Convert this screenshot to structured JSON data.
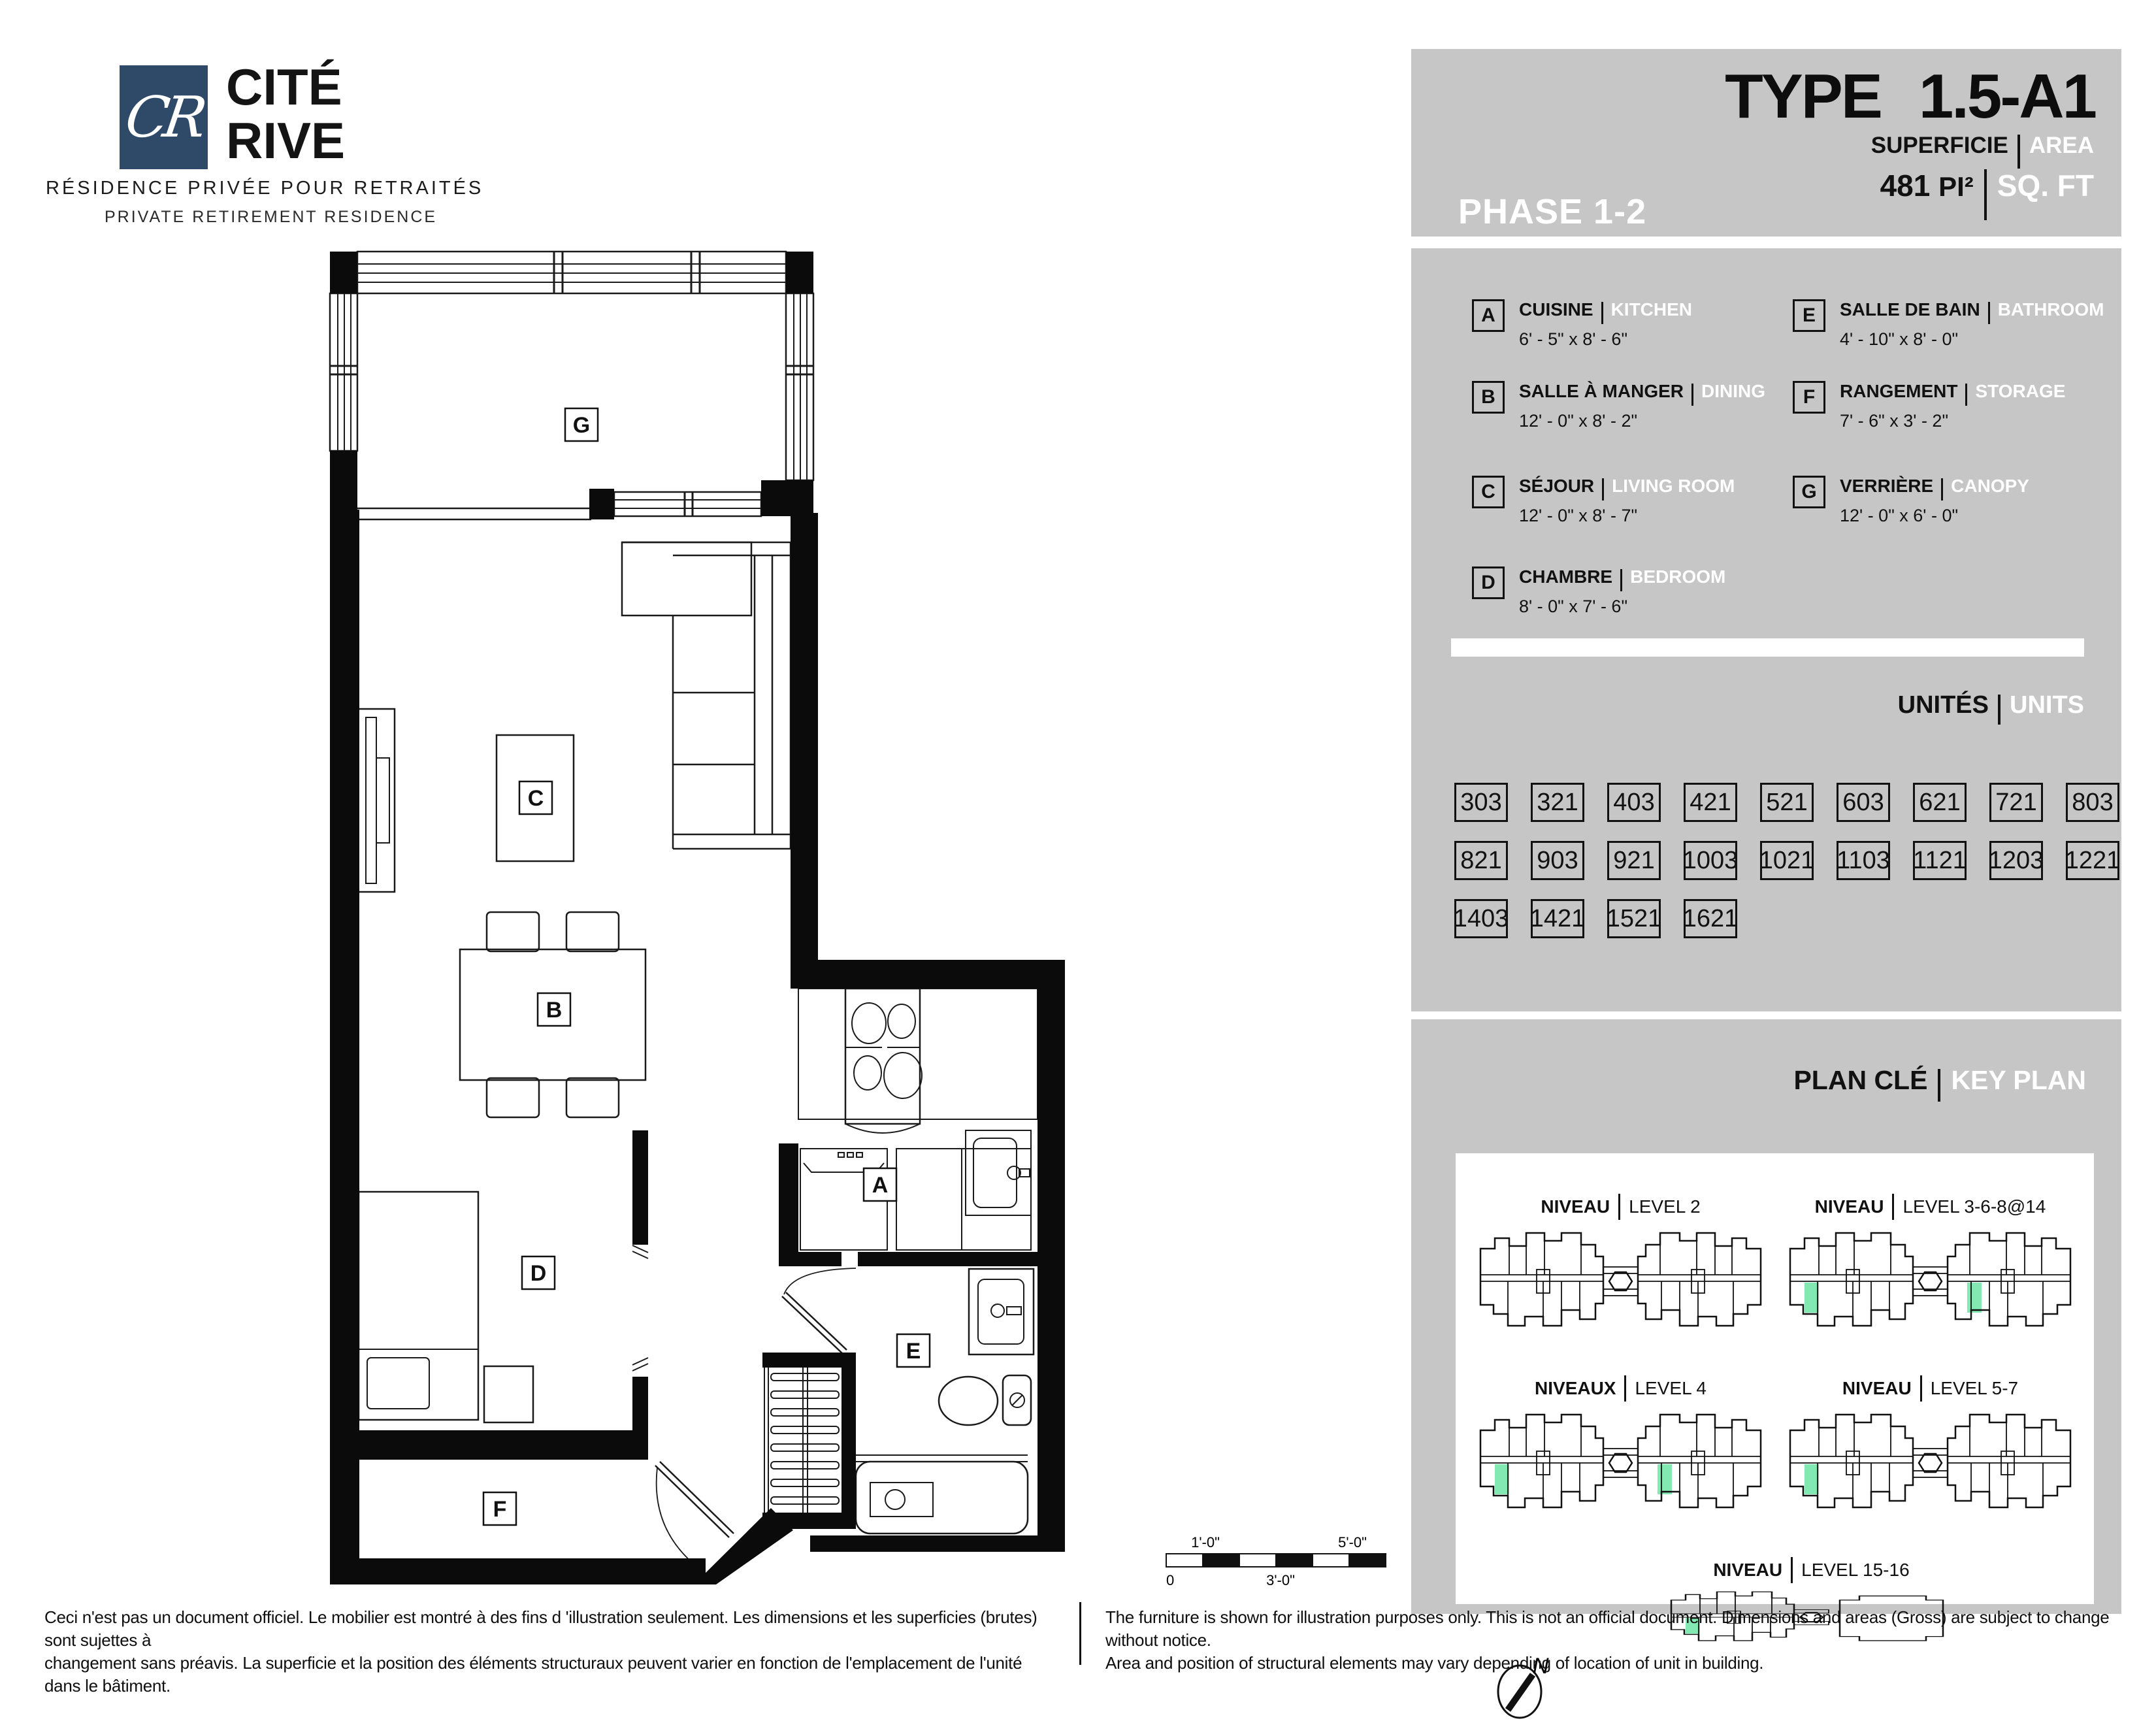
{
  "colors": {
    "navy": "#2f4a68",
    "panel_gray": "#c6c6c6",
    "highlight_green": "#82e9b2",
    "ink": "#111111"
  },
  "logo": {
    "monogram": "CR",
    "name_line1": "CITÉ",
    "name_line2": "RIVE",
    "tagline_fr": "RÉSIDENCE PRIVÉE POUR RETRAITÉS",
    "tagline_en": "PRIVATE RETIREMENT RESIDENCE"
  },
  "header": {
    "phase": "PHASE 1-2",
    "type_label": "TYPE",
    "type_value": "1.5-A1",
    "superficie_fr": "SUPERFICIE",
    "superficie_en": "AREA",
    "area_value": "481",
    "area_unit_fr": "PI²",
    "area_unit_en": "SQ. FT"
  },
  "legend": {
    "items": [
      {
        "letter": "A",
        "name_fr": "CUISINE",
        "name_en": "KITCHEN",
        "dims": "6' - 5\" x 8' - 6\""
      },
      {
        "letter": "B",
        "name_fr": "SALLE À MANGER",
        "name_en": "DINING",
        "dims": "12' - 0\" x 8' - 2\""
      },
      {
        "letter": "C",
        "name_fr": "SÉJOUR",
        "name_en": "LIVING ROOM",
        "dims": "12' - 0\" x 8' - 7\""
      },
      {
        "letter": "D",
        "name_fr": "CHAMBRE",
        "name_en": "BEDROOM",
        "dims": "8' - 0\" x 7' - 6\""
      },
      {
        "letter": "E",
        "name_fr": "SALLE DE BAIN",
        "name_en": "BATHROOM",
        "dims": "4' - 10\" x 8' - 0\""
      },
      {
        "letter": "F",
        "name_fr": "RANGEMENT",
        "name_en": "STORAGE",
        "dims": "7' - 6\" x 3' - 2\""
      },
      {
        "letter": "G",
        "name_fr": "VERRIÈRE",
        "name_en": "CANOPY",
        "dims": "12' - 0\" x 6' - 0\""
      }
    ]
  },
  "units": {
    "title_fr": "UNITÉS",
    "title_en": "UNITS",
    "numbers": [
      "303",
      "321",
      "403",
      "421",
      "521",
      "603",
      "621",
      "721",
      "803",
      "821",
      "903",
      "921",
      "1003",
      "1021",
      "1103",
      "1121",
      "1203",
      "1221",
      "1403",
      "1421",
      "1521",
      "1621"
    ]
  },
  "keyplan": {
    "title_fr": "PLAN CLÉ",
    "title_en": "KEY PLAN",
    "compass_letter": "N",
    "levels": [
      {
        "label_fr": "NIVEAU",
        "label_en": "LEVEL 2",
        "highlights": "none",
        "variant": "twin"
      },
      {
        "label_fr": "NIVEAU",
        "label_en": "LEVEL 3-6-8@14",
        "highlights": "both",
        "variant": "twin"
      },
      {
        "label_fr": "NIVEAUX",
        "label_en": "LEVEL 4",
        "highlights": "both",
        "variant": "twin"
      },
      {
        "label_fr": "NIVEAU",
        "label_en": "LEVEL 5-7",
        "highlights": "left",
        "variant": "twin"
      },
      {
        "label_fr": "NIVEAU",
        "label_en": "LEVEL 15-16",
        "highlights": "left",
        "variant": "tower"
      }
    ]
  },
  "plan": {
    "room_markers": [
      "G",
      "C",
      "B",
      "A",
      "D",
      "E",
      "F"
    ]
  },
  "scalebar": {
    "zero": "0",
    "one": "1'-0\"",
    "three": "3'-0\"",
    "five": "5'-0\""
  },
  "footer": {
    "fr_line1": "Ceci n'est pas un document officiel.  Le mobilier est montré à des fins d 'illustration seulement.  Les dimensions et les superficies (brutes) sont sujettes à",
    "fr_line2": "changement sans préavis. La superficie et la position des éléments structuraux peuvent varier en fonction de l'emplacement de l'unité dans le bâtiment.",
    "en_line1": "The furniture is shown for illustration purposes only.  This is not an official document.  Dimensions and areas (Gross) are subject to change without notice.",
    "en_line2": "Area and position of structural elements may vary depending of location of unit in building."
  }
}
